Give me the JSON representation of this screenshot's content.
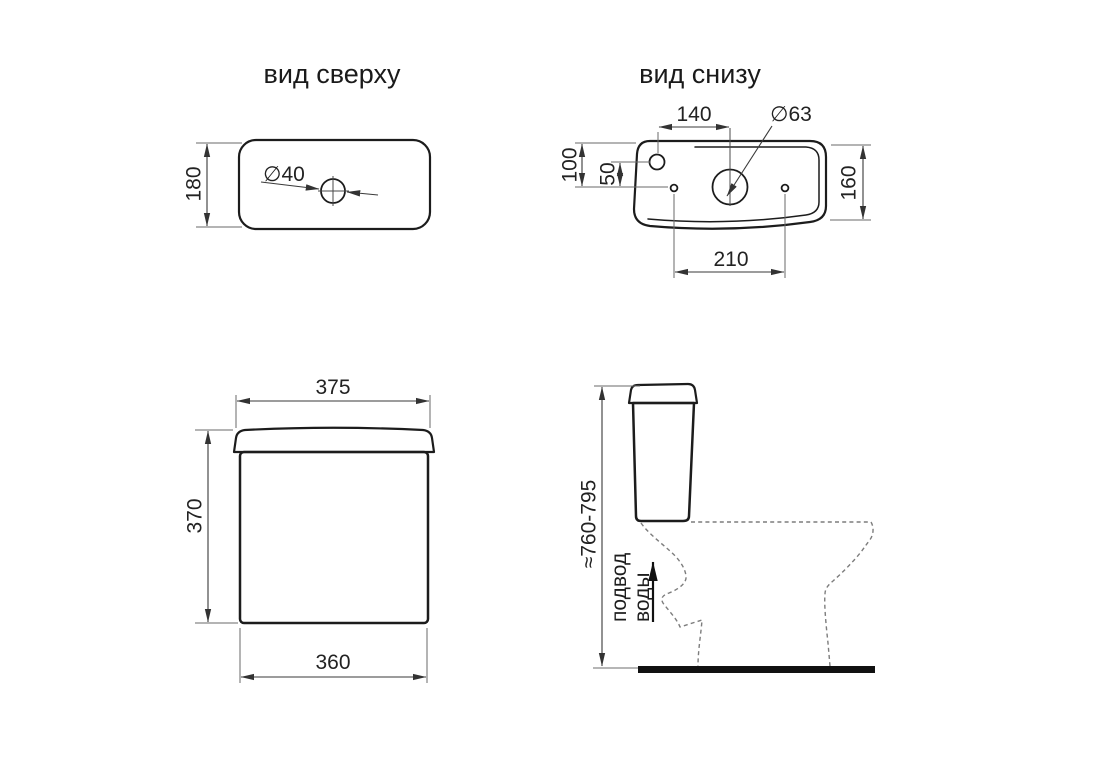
{
  "titles": {
    "top_view": "вид сверху",
    "bottom_view": "вид снизу"
  },
  "dimensions": {
    "top_view": {
      "depth": "180",
      "lid_button_hole": "∅40"
    },
    "bottom_view": {
      "inlet_offset_x": "140",
      "flush_valve_hole": "∅63",
      "inlet_offset_y": "100",
      "inlet_to_bolt_line": "50",
      "depth": "160",
      "bolt_spacing": "210"
    },
    "front_view": {
      "lid_width": "375",
      "height": "370",
      "body_width": "360"
    },
    "side_view": {
      "installed_height": "≈760-795",
      "water_supply_line1": "подвод",
      "water_supply_line2": "воды"
    }
  },
  "colors": {
    "outline": "#1c1c1c",
    "dimension_lines": "#3a3a3a",
    "dashed_silhouette": "#7d7d7d",
    "floor_bar": "#111111",
    "background": "#ffffff"
  }
}
